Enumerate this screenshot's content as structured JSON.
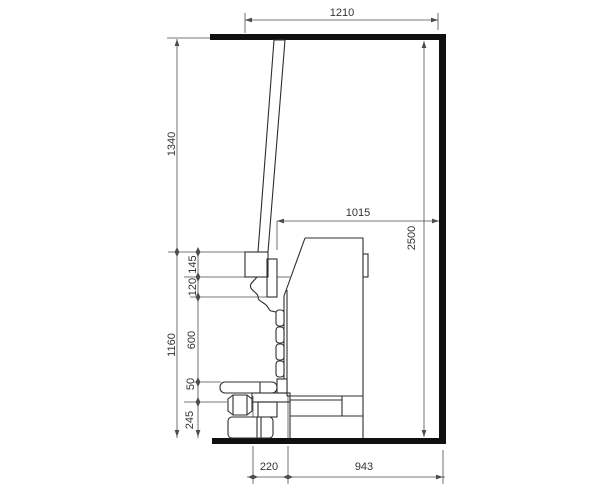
{
  "drawing": {
    "type": "technical-side-elevation",
    "dimensions": {
      "top_span": "1210",
      "left_upper": "1340",
      "left_lower": "1160",
      "overall_height": "2500",
      "mid_span": "1015",
      "seg_head": "145",
      "seg_neck": "120",
      "seg_column": "600",
      "seg_table": "50",
      "seg_jack": "245",
      "bottom_inner": "220",
      "bottom_outer": "943"
    },
    "colors": {
      "outline": "#2e2e2e",
      "dimension": "#4d4d4d",
      "structure": "#101010",
      "background": "#ffffff"
    }
  }
}
